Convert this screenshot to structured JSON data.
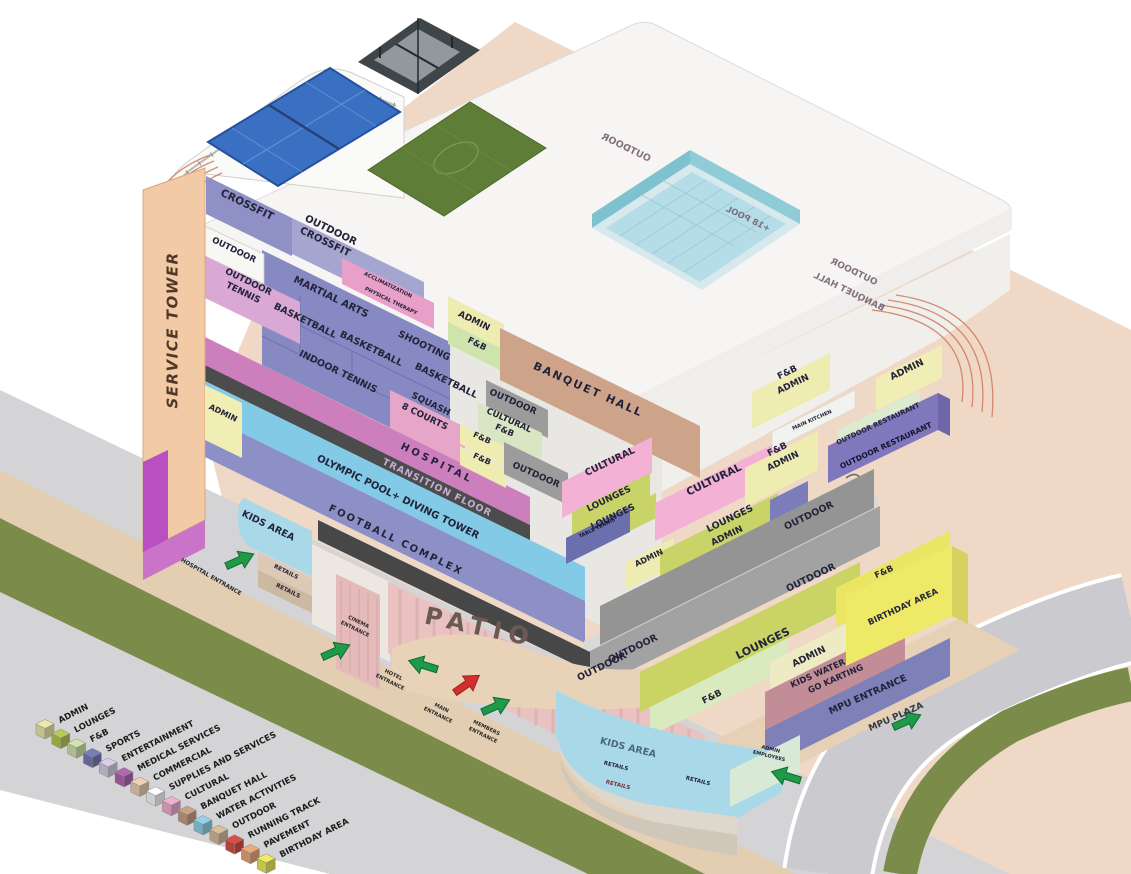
{
  "title": "Mixed-use complex program axonometric diagram",
  "palette": {
    "arrow_green": "#1e9a48",
    "arrow_green_edge": "#0d6b2e",
    "arrow_red": "#d03030",
    "arrow_red_edge": "#9c1f1f",
    "label_dark": "#23233a",
    "transition_text": "#c3aed3",
    "mirror_text": "#715a6b"
  },
  "legend": {
    "items": [
      {
        "label": "ADMIN",
        "color": "#eeeaa8"
      },
      {
        "label": "LOUNGES",
        "color": "#b9c957"
      },
      {
        "label": "F&B",
        "color": "#d2e5ae"
      },
      {
        "label": "SPORTS",
        "color": "#7a7cba"
      },
      {
        "label": "ENTERTAINMENT",
        "color": "#d9cfe8"
      },
      {
        "label": "MEDICAL SERVICES",
        "color": "#b465b2"
      },
      {
        "label": "COMMERCIAL",
        "color": "#eed3b4"
      },
      {
        "label": "SUPPLIES AND SERVICES",
        "color": "#fdfdfd"
      },
      {
        "label": "CULTURAL",
        "color": "#f2afd4"
      },
      {
        "label": "BANQUET HALL",
        "color": "#c9a183"
      },
      {
        "label": "WATER ACTIVITIES",
        "color": "#8fd4ec"
      },
      {
        "label": "OUTDOOR",
        "color": "#d8bd9e"
      },
      {
        "label": "RUNNING TRACK",
        "color": "#d94f45"
      },
      {
        "label": "PAVEMENT",
        "color": "#f0a878"
      },
      {
        "label": "BIRTHDAY AREA",
        "color": "#f0ee58"
      }
    ]
  },
  "labels": [
    {
      "n": "service-tower",
      "t": "SERVICE TOWER",
      "x": 173,
      "y": 330,
      "r": -90,
      "s": 15,
      "f": "#503828",
      "ls": 1.5,
      "it": true
    },
    {
      "n": "crossfit",
      "t": "CROSSFIT",
      "x": 247,
      "y": 205,
      "r": 26,
      "s": 10.5
    },
    {
      "n": "outdoor-crossfit",
      "t": [
        "OUTDOOR",
        "CROSSFIT"
      ],
      "x": 328,
      "y": 236,
      "r": 26,
      "s": 10,
      "lh": 13
    },
    {
      "n": "outdoor-box",
      "t": "OUTDOOR",
      "x": 234,
      "y": 250,
      "r": 26,
      "s": 8.5
    },
    {
      "n": "outdoor-tennis",
      "t": [
        "OUTDOOR",
        "TENNIS"
      ],
      "x": 246,
      "y": 287,
      "r": 26,
      "s": 9,
      "lh": 12
    },
    {
      "n": "martial-arts",
      "t": "MARTIAL ARTS",
      "x": 331,
      "y": 297,
      "r": 26,
      "s": 10
    },
    {
      "n": "basketball-1",
      "t": "BASKETBALL",
      "x": 305,
      "y": 321,
      "r": 26,
      "s": 9.5
    },
    {
      "n": "basketball-2",
      "t": "BASKETBALL",
      "x": 371,
      "y": 349,
      "r": 26,
      "s": 9.5
    },
    {
      "n": "shooting",
      "t": "SHOOTING",
      "x": 424,
      "y": 346,
      "r": 26,
      "s": 9.5
    },
    {
      "n": "indoor-tennis",
      "t": "INDOOR  TENNIS",
      "x": 338,
      "y": 372,
      "r": 26,
      "s": 9.5
    },
    {
      "n": "basketball-3",
      "t": "BASKETBALL",
      "x": 446,
      "y": 381,
      "r": 26,
      "s": 9.5
    },
    {
      "n": "squash",
      "t": [
        "SQUASH",
        "8 COURTS"
      ],
      "x": 428,
      "y": 410,
      "r": 26,
      "s": 9,
      "lh": 14
    },
    {
      "n": "acclimatization",
      "t": "ACCLIMATIZATION",
      "x": 388,
      "y": 285,
      "r": 26,
      "s": 5.2
    },
    {
      "n": "physical-therapy",
      "t": "PHYSICAL THERAPY",
      "x": 391,
      "y": 301,
      "r": 26,
      "s": 5.2
    },
    {
      "n": "admin-mid",
      "t": "ADMIN",
      "x": 474,
      "y": 321,
      "r": 26,
      "s": 9
    },
    {
      "n": "fnb-mid",
      "t": "F&B",
      "x": 477,
      "y": 344,
      "r": 26,
      "s": 8.5
    },
    {
      "n": "hospital",
      "t": "HOSPITAL",
      "x": 437,
      "y": 463,
      "r": 26,
      "s": 10,
      "ls": 3
    },
    {
      "n": "transition-floor",
      "t": "TRANSITION FLOOR",
      "x": 437,
      "y": 488,
      "r": 26,
      "s": 9.5,
      "f": "#c3aed3",
      "ls": 1
    },
    {
      "n": "olympic-pool",
      "t": "OLYMPIC POOL+ DIVING TOWER",
      "x": 398,
      "y": 497,
      "r": 26,
      "s": 10
    },
    {
      "n": "football-complex",
      "t": "FOOTBALL COMPLEX",
      "x": 396,
      "y": 540,
      "r": 26,
      "s": 10,
      "ls": 2
    },
    {
      "n": "kids-area-left",
      "t": "KIDS AREA",
      "x": 268,
      "y": 526,
      "r": 26,
      "s": 9.5
    },
    {
      "n": "admin-tower",
      "t": "ADMIN",
      "x": 223,
      "y": 413,
      "r": 26,
      "s": 8
    },
    {
      "n": "retails-1",
      "t": "RETAILS",
      "x": 286,
      "y": 572,
      "r": 26,
      "s": 5.8
    },
    {
      "n": "retails-2",
      "t": "RETAILS",
      "x": 288,
      "y": 591,
      "r": 26,
      "s": 5.8
    },
    {
      "n": "hospital-entrance",
      "t": "HOSPITAL ENTRANCE",
      "x": 211,
      "y": 577,
      "r": 30,
      "s": 5.8,
      "f": "#2a2a2a"
    },
    {
      "n": "cinema-entrance",
      "t": [
        "CINEMA",
        "ENTRANCE"
      ],
      "x": 357,
      "y": 625,
      "r": 26,
      "s": 5.2,
      "lh": 8,
      "f": "#2a2a2a"
    },
    {
      "n": "hotel-entrance",
      "t": [
        "HOTEL",
        "ENTRANCE"
      ],
      "x": 392,
      "y": 678,
      "r": 26,
      "s": 5.2,
      "lh": 8,
      "f": "#2a2a2a"
    },
    {
      "n": "main-entrance",
      "t": [
        "MAIN",
        "ENTRANCE"
      ],
      "x": 440,
      "y": 711,
      "r": 26,
      "s": 5.2,
      "lh": 8,
      "f": "#2a2a2a"
    },
    {
      "n": "members-entrance",
      "t": [
        "MEMBERS",
        "ENTRANCE"
      ],
      "x": 485,
      "y": 731,
      "r": 26,
      "s": 5.2,
      "lh": 8,
      "f": "#2a2a2a"
    },
    {
      "n": "patio",
      "t": "PATIO",
      "x": 480,
      "y": 628,
      "r": 12,
      "s": 24,
      "ls": 7,
      "f": "#6a5a52"
    },
    {
      "n": "banquet-hall",
      "t": "BANQUET HALL",
      "x": 588,
      "y": 390,
      "r": 24,
      "s": 11,
      "ls": 2
    },
    {
      "n": "outdoor-a",
      "t": "OUTDOOR",
      "x": 513,
      "y": 402,
      "r": 24,
      "s": 9
    },
    {
      "n": "cultural-fnb",
      "t": [
        "CULTURAL",
        "F&B"
      ],
      "x": 507,
      "y": 425,
      "r": 24,
      "s": 8.5,
      "lh": 11
    },
    {
      "n": "fnb-small-1",
      "t": "F&B",
      "x": 482,
      "y": 438,
      "r": 24,
      "s": 8
    },
    {
      "n": "fnb-small-2",
      "t": "F&B",
      "x": 482,
      "y": 459,
      "r": 24,
      "s": 8
    },
    {
      "n": "outdoor-b",
      "t": "OUTDOOR",
      "x": 536,
      "y": 475,
      "r": 24,
      "s": 9
    },
    {
      "n": "cultural-1",
      "t": "CULTURAL",
      "x": 610,
      "y": 462,
      "r": -26,
      "s": 9.5
    },
    {
      "n": "cultural-2",
      "t": "CULTURAL",
      "x": 714,
      "y": 480,
      "r": -26,
      "s": 10.5
    },
    {
      "n": "lounges-1",
      "t": "LOUNGES",
      "x": 609,
      "y": 499,
      "r": -26,
      "s": 9
    },
    {
      "n": "lounges-2",
      "t": "LOUNGES",
      "x": 613,
      "y": 517,
      "r": -26,
      "s": 9
    },
    {
      "n": "table-tennis",
      "t": "TABLE TENNIS",
      "x": 597,
      "y": 528,
      "r": -26,
      "s": 5,
      "f": "#14142c"
    },
    {
      "n": "admin-corner",
      "t": "ADMIN",
      "x": 649,
      "y": 558,
      "r": -26,
      "s": 8
    },
    {
      "n": "lounges-3",
      "t": "LOUNGES",
      "x": 730,
      "y": 519,
      "r": -26,
      "s": 9.5
    },
    {
      "n": "admin-d",
      "t": "ADMIN",
      "x": 727,
      "y": 536,
      "r": -26,
      "s": 9
    },
    {
      "n": "fnb-admin-upper",
      "t": [
        "F&B",
        "ADMIN"
      ],
      "x": 790,
      "y": 378,
      "r": -26,
      "s": 9,
      "lh": 13
    },
    {
      "n": "main-kitchen",
      "t": "MAIN KITCHEN",
      "x": 812,
      "y": 420,
      "r": -24,
      "s": 5.2
    },
    {
      "n": "fnb-admin-lower",
      "t": [
        "F&B",
        "ADMIN"
      ],
      "x": 780,
      "y": 455,
      "r": -26,
      "s": 9,
      "lh": 13
    },
    {
      "n": "admin-top-right",
      "t": "ADMIN",
      "x": 907,
      "y": 370,
      "r": -26,
      "s": 9.5
    },
    {
      "n": "outdoor-restaurant-band",
      "t": "OUTDOOR RESTAURANT",
      "x": 878,
      "y": 424,
      "r": -25,
      "s": 6.8
    },
    {
      "n": "outdoor-restaurant-box",
      "t": "OUTDOOR RESTAURANT",
      "x": 886,
      "y": 446,
      "r": -25,
      "s": 7.5,
      "f": "#14142c"
    },
    {
      "n": "outdoor-gray-1",
      "t": "OUTDOOR",
      "x": 809,
      "y": 516,
      "r": -26,
      "s": 9.5
    },
    {
      "n": "outdoor-gray-2",
      "t": "OUTDOOR",
      "x": 811,
      "y": 578,
      "r": -26,
      "s": 9.5
    },
    {
      "n": "outdoor-gray-3",
      "t": "OUTDOOR",
      "x": 633,
      "y": 649,
      "r": -26,
      "s": 9.5
    },
    {
      "n": "outdoor-gray-4",
      "t": "OUTDOOR",
      "x": 602,
      "y": 667,
      "r": -26,
      "s": 9.5
    },
    {
      "n": "lounges-big",
      "t": "LOUNGES",
      "x": 763,
      "y": 644,
      "r": -26,
      "s": 11
    },
    {
      "n": "admin-e",
      "t": "ADMIN",
      "x": 809,
      "y": 657,
      "r": -26,
      "s": 9.5
    },
    {
      "n": "fnb-wing",
      "t": "F&B",
      "x": 712,
      "y": 697,
      "r": -26,
      "s": 9
    },
    {
      "n": "kids-water-park",
      "t": [
        "KIDS WATER PARK",
        "GO KARTING"
      ],
      "x": 833,
      "y": 673,
      "r": -24,
      "s": 8.5,
      "lh": 12,
      "layer": "under"
    },
    {
      "n": "birthday-area",
      "t": "BIRTHDAY AREA",
      "x": 903,
      "y": 607,
      "r": -25,
      "s": 8.5
    },
    {
      "n": "fnb-yellow",
      "t": "F&B",
      "x": 884,
      "y": 572,
      "r": -25,
      "s": 8.5
    },
    {
      "n": "mpu-entrance",
      "t": "MPU ENTRANCE",
      "x": 868,
      "y": 695,
      "r": -24,
      "s": 9.5
    },
    {
      "n": "mpu-plaza",
      "t": "MPU PLAZA",
      "x": 896,
      "y": 717,
      "r": -24,
      "s": 9,
      "f": "#3a3a3a"
    },
    {
      "n": "kids-area-right",
      "t": "KIDS AREA",
      "x": 628,
      "y": 748,
      "r": 14,
      "s": 9.5,
      "f": "#4a6878"
    },
    {
      "n": "retails-3",
      "t": "RETAILS",
      "x": 616,
      "y": 766,
      "r": 14,
      "s": 5.5
    },
    {
      "n": "retails-4",
      "t": "RETAILS",
      "x": 618,
      "y": 785,
      "r": 14,
      "s": 5.5,
      "f": "#7a3030"
    },
    {
      "n": "retails-5",
      "t": "RETAILS",
      "x": 698,
      "y": 781,
      "r": 14,
      "s": 5.5
    },
    {
      "n": "admin-employees",
      "t": [
        "ADMIN",
        "EMPLOYEES"
      ],
      "x": 770,
      "y": 752,
      "r": 14,
      "s": 5,
      "lh": 7
    },
    {
      "n": "outdoor-mirror-top",
      "t": "OUTDOOR",
      "x": 626,
      "y": 148,
      "r": 26,
      "s": 9.5,
      "m": true,
      "f": "#715a6b"
    },
    {
      "n": "pool-18",
      "t": "+18 POOL",
      "x": 748,
      "y": 219,
      "r": 26,
      "s": 8.5,
      "m": true,
      "f": "#715a6b"
    },
    {
      "n": "outdoor-mirror-2",
      "t": "OUTDOOR",
      "x": 854,
      "y": 272,
      "r": 26,
      "s": 9,
      "m": true,
      "f": "#715a6b"
    },
    {
      "n": "banquet-mirror",
      "t": "BANQUET HALL",
      "x": 849,
      "y": 292,
      "r": 26,
      "s": 9,
      "m": true,
      "f": "#715a6b"
    }
  ],
  "arrows": [
    {
      "n": "hospital-entrance-arrow",
      "x": 240,
      "y": 560,
      "r": -24,
      "c": "green"
    },
    {
      "n": "cinema-entrance-arrow",
      "x": 336,
      "y": 651,
      "r": -24,
      "c": "green"
    },
    {
      "n": "hotel-entrance-arrow",
      "x": 423,
      "y": 665,
      "r": 197,
      "c": "green"
    },
    {
      "n": "main-entrance-arrow",
      "x": 467,
      "y": 684,
      "r": -35,
      "c": "red"
    },
    {
      "n": "members-entrance-arrow",
      "x": 496,
      "y": 706,
      "r": -24,
      "c": "green"
    },
    {
      "n": "employees-arrow",
      "x": 786,
      "y": 776,
      "r": 197,
      "c": "green"
    },
    {
      "n": "mpu-plaza-arrow",
      "x": 907,
      "y": 721,
      "r": -24,
      "c": "green"
    }
  ]
}
